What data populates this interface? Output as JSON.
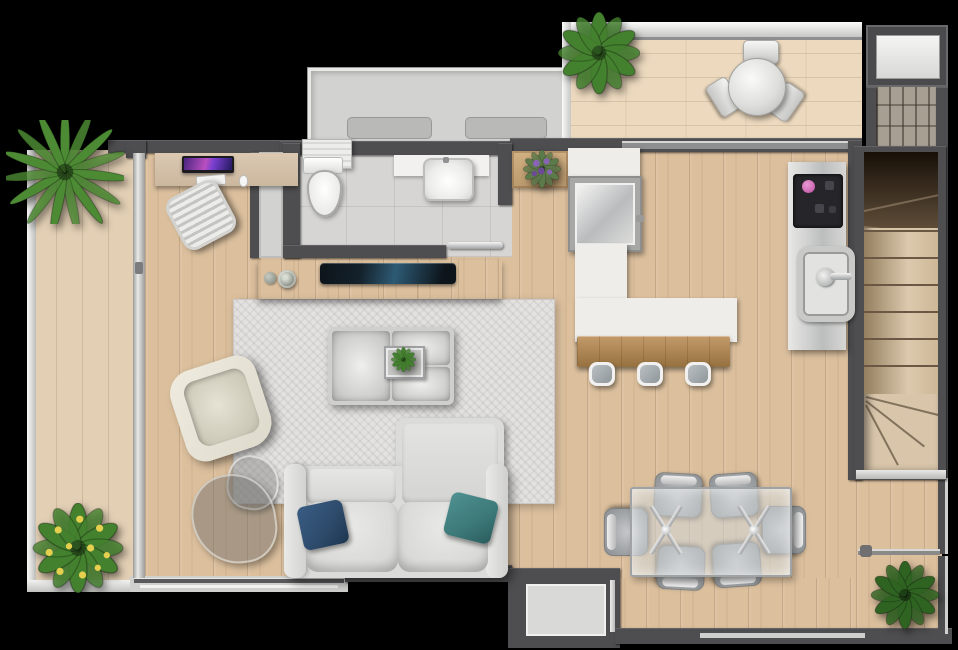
{
  "scene": {
    "type": "apartment floor plan, top-down 3D render, no visible text",
    "background": "black",
    "rooms": [
      {
        "name": "left-balcony",
        "features": [
          "wood deck",
          "glass railing",
          "palm plant",
          "yellow flower bush",
          "sliding glass door"
        ]
      },
      {
        "name": "living-room",
        "features": [
          "desk with monitor",
          "keyboard",
          "mouse",
          "office chair",
          "tv console with tv and two vases",
          "area rug",
          "tufted ottoman with tray and small plant",
          "armchair",
          "two glass side tables",
          "sofa with chaise",
          "navy pillow",
          "teal pillow"
        ]
      },
      {
        "name": "bathroom",
        "features": [
          "toilet",
          "vanity sink",
          "tiled floor",
          "chrome sliding door handle",
          "dark window"
        ]
      },
      {
        "name": "upper-terrace",
        "features": [
          "gray deck",
          "two gray mats",
          "white louver unit"
        ]
      },
      {
        "name": "upper-balcony",
        "features": [
          "wood deck",
          "railing",
          "round bistro table",
          "three chairs",
          "green plant"
        ]
      },
      {
        "name": "kitchen",
        "features": [
          "shelf with purple flowers",
          "large square sink",
          "l-shaped white counter",
          "wood breakfast bar",
          "three stools",
          "appliance column with cooktop and oven door",
          "pink control knob"
        ]
      },
      {
        "name": "dining-area",
        "features": [
          "glass dining table with x legs",
          "six gray chairs",
          "corner plant"
        ]
      },
      {
        "name": "entry-stairs",
        "features": [
          "elevator shaft box",
          "brick landing",
          "winder staircase",
          "railing",
          "plant"
        ]
      }
    ],
    "counts": {
      "plants": 6,
      "dining_chairs": 6,
      "bar_stools": 3,
      "balcony_chairs": 3,
      "stair_treads": 6
    }
  },
  "palette": {
    "wall": "#4e4e50",
    "wood-main": "#dcc09e",
    "wood-balcony": "#e2cfb4",
    "wood-top": "#ecd9be",
    "wood-bar": "#b08350",
    "wood-console": "#c8a97e",
    "tile": "#d6d5d3",
    "terrace": "#d2d2d0",
    "rug": "#e3e2e0",
    "counter": "#eeedea",
    "sofa": "#dbdbd9",
    "steel-light": "#f0f0ee",
    "steel-dark": "#aeb0b2",
    "tv": "#14212b",
    "pillow-navy": "#2d4a6a",
    "pillow-teal": "#3c7878",
    "leaf": "#44812f",
    "leaf-dark": "#2f6322",
    "palm": "#4c8a33",
    "flower-yellow": "#e4cf4e",
    "flower-purple": "#8a64b4",
    "knob-pink": "#d06cb6",
    "brick": "#a89f93",
    "glass": "rgba(120,120,118,0.40)"
  }
}
